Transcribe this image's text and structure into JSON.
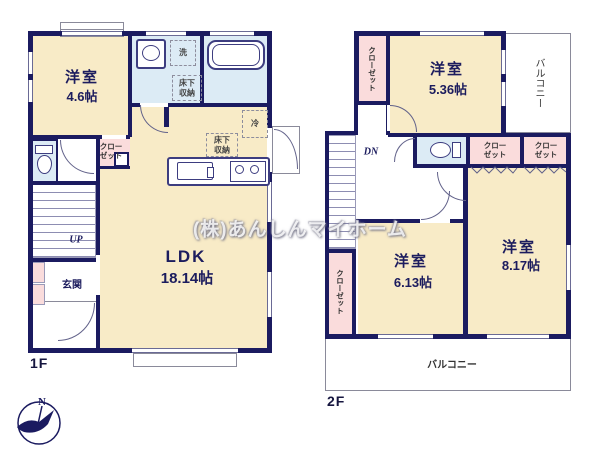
{
  "watermark": "(株)あんしんマイホーム",
  "compass": {
    "north": "N"
  },
  "colors": {
    "wall": "#1b1b60",
    "room": "#f8ebc7",
    "wet": "#dcebf5",
    "closet": "#fadcdc"
  },
  "floor1": {
    "label": "1F",
    "west_room": {
      "name": "洋室",
      "area": "4.6帖"
    },
    "ldk": {
      "name": "LDK",
      "area": "18.14帖"
    },
    "entrance": "玄関",
    "closet": "クロー\nゼット",
    "stairs_up": "UP",
    "laundry": "洗",
    "underfloor_storage_a": "床下\n収納",
    "underfloor_storage_b": "床下\n収納",
    "fridge": "冷"
  },
  "floor2": {
    "label": "2F",
    "room_a": {
      "name": "洋室",
      "area": "5.36帖"
    },
    "room_b": {
      "name": "洋室",
      "area": "6.13帖"
    },
    "room_c": {
      "name": "洋室",
      "area": "8.17帖"
    },
    "balcony_side": "バルコニー",
    "balcony_main": "バルコニー",
    "closet_nw": "クローゼット",
    "closet_sw": "クローゼット",
    "closet_a": "クロー\nゼット",
    "closet_b": "クロー\nゼット",
    "stairs_down": "DN"
  }
}
